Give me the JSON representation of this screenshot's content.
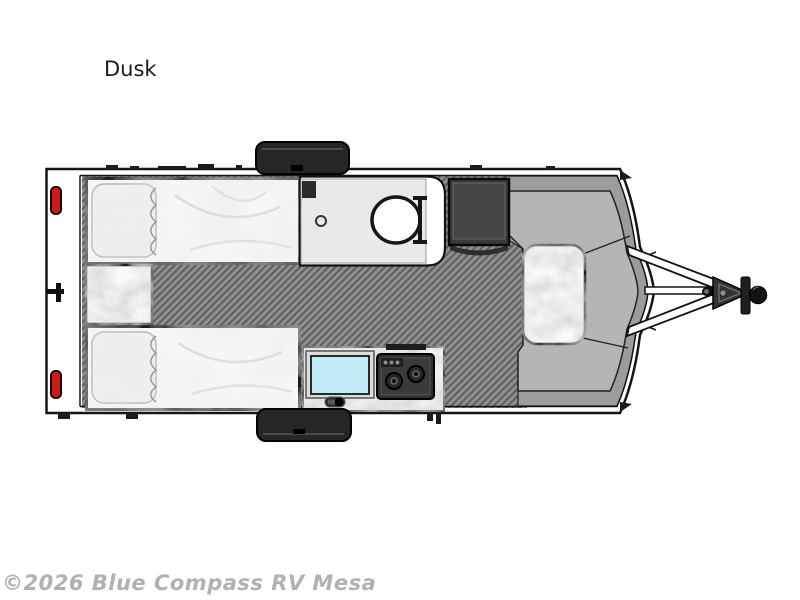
{
  "page": {
    "title": "Dusk",
    "watermark": "©2026 Blue Compass RV Mesa"
  },
  "floorplan": {
    "type": "travel-trailer floor plan, top view, hitch on right",
    "features": [
      "twin-bed-upper",
      "twin-bed-lower",
      "nightstand",
      "bathroom-with-toilet",
      "wardrobe-cabinet",
      "kitchen-counter",
      "sink",
      "two-burner-stove",
      "wrap-around-dinette",
      "dinette-table",
      "tail-lights",
      "wheels",
      "a-frame-hitch"
    ],
    "colors": {
      "floor": "#8f8f8f",
      "floor_stripe": "#5e5e5e",
      "bench": "#b5b5b5",
      "cap_trim": "#9c9c9c",
      "sink": "#c3eef8",
      "tail_light": "#c41e1e",
      "appliance_dark": "#2f2f2f",
      "outline": "#151515"
    }
  }
}
